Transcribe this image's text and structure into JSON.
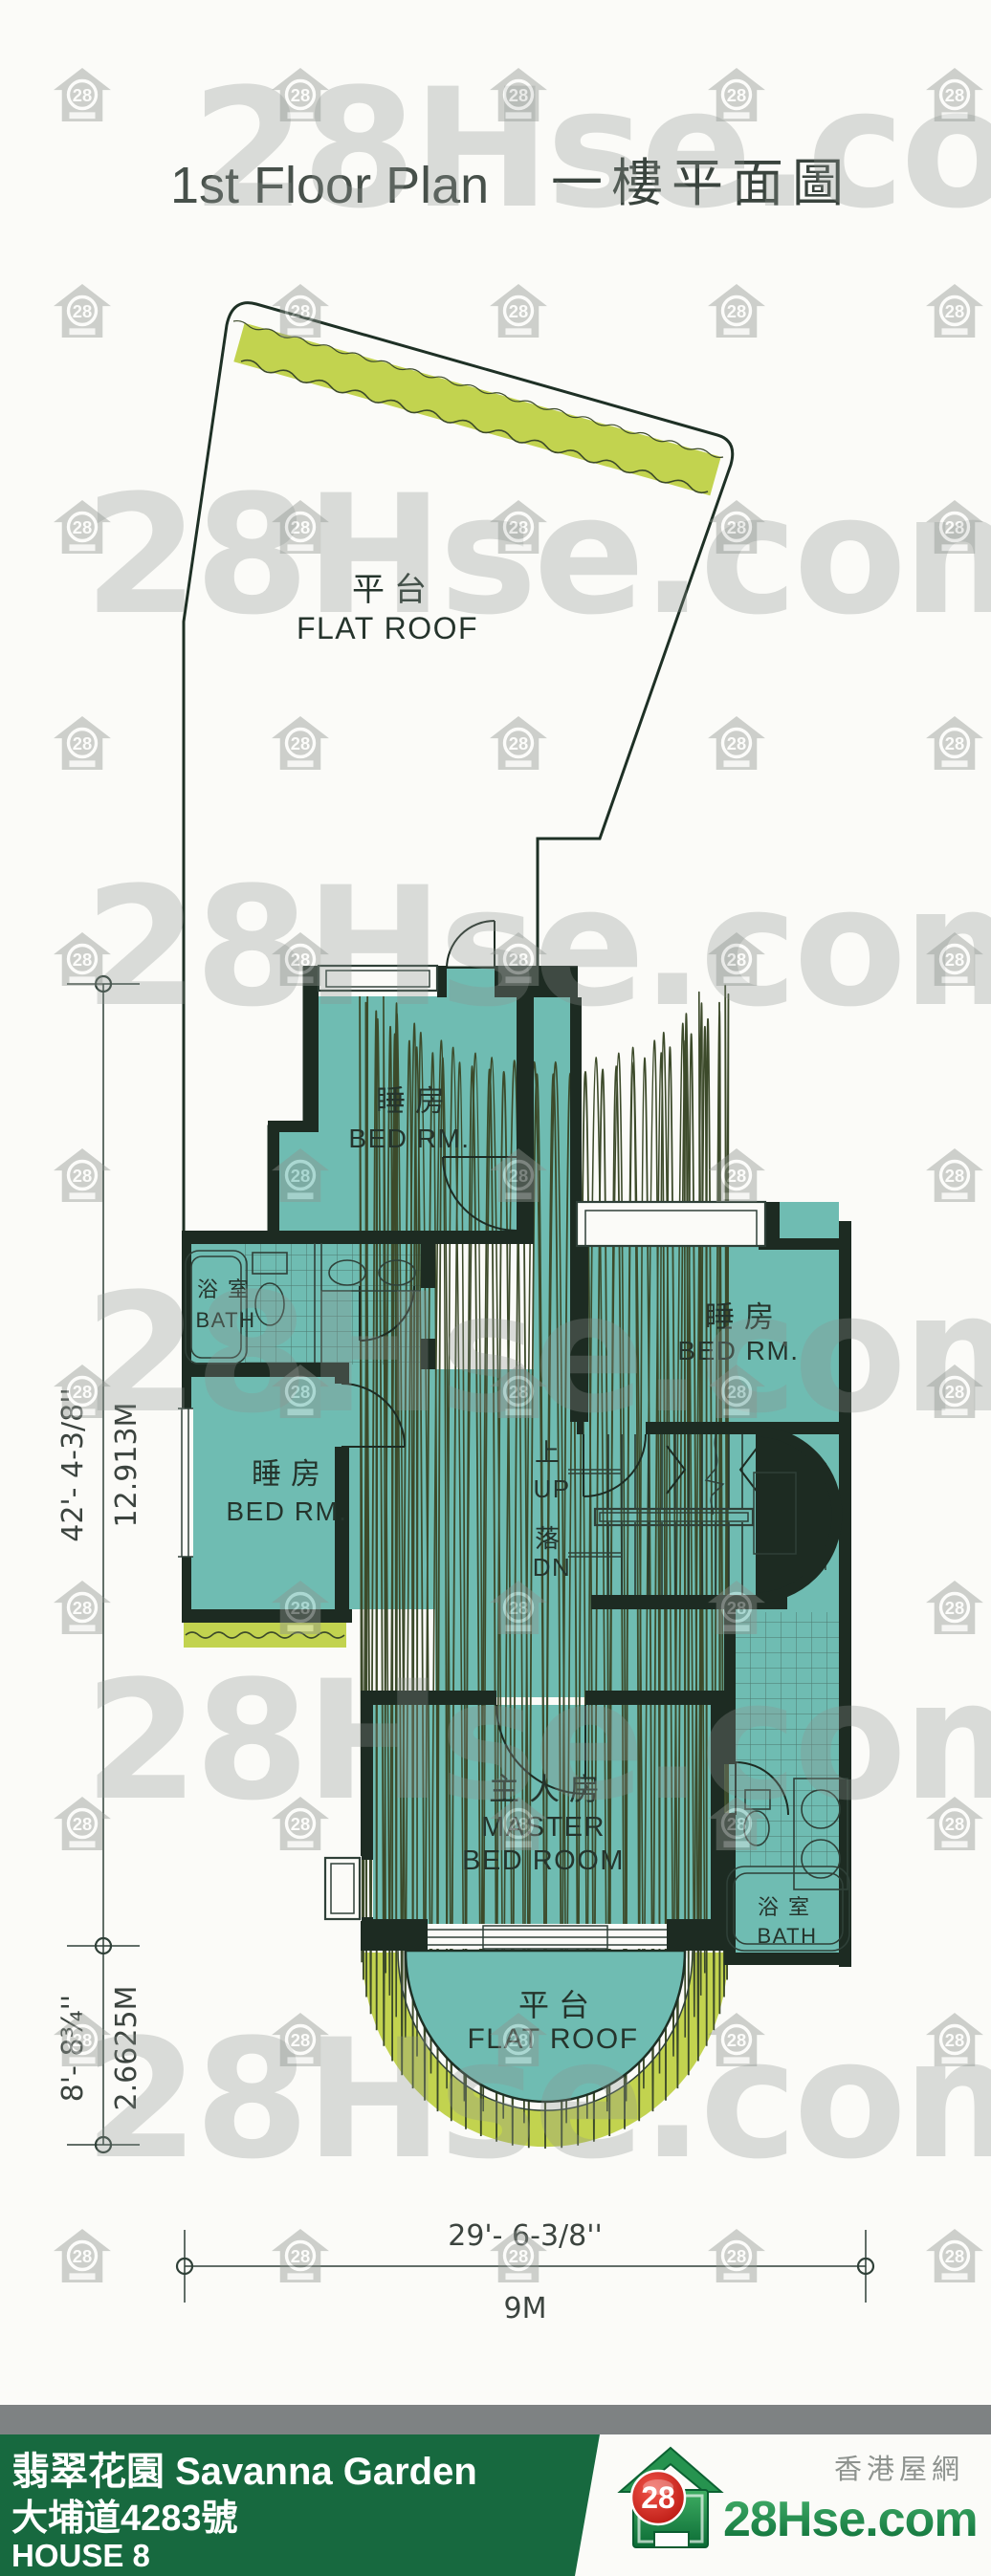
{
  "title": {
    "en": "1st Floor Plan",
    "zh": "一樓平面圖"
  },
  "watermark": {
    "text": "28Hse.com",
    "badge": "28"
  },
  "plan": {
    "flat_roof_top": {
      "zh": "平台",
      "en": "FLAT ROOF"
    },
    "flat_roof_bottom": {
      "zh": "平台",
      "en": "FLAT ROOF"
    },
    "bedroom_top": {
      "zh": "睡房",
      "en": "BED RM."
    },
    "bedroom_right": {
      "zh": "睡房",
      "en": "BED RM."
    },
    "bedroom_left": {
      "zh": "睡房",
      "en": "BED RM."
    },
    "bath_left": {
      "zh": "浴室",
      "en": "BATH"
    },
    "bath_right": {
      "zh": "浴室",
      "en": "BATH"
    },
    "master_bedroom": {
      "zh": "主人房",
      "en_line1": "MASTER",
      "en_line2": "BED ROOM"
    },
    "stairs": {
      "up_zh": "上",
      "up_en": "UP",
      "down_zh": "落",
      "down_en": "DN"
    }
  },
  "dimensions": {
    "left_upper": {
      "imperial": "42'- 4-3/8''",
      "metric": "12.913M"
    },
    "left_lower": {
      "imperial": "8'- 8¾''",
      "metric": "2.6625M"
    },
    "bottom": {
      "imperial": "29'- 6-3/8''",
      "metric": "9M"
    }
  },
  "footer": {
    "estate_name": "翡翠花園 Savanna Garden",
    "address": "大埔道4283號",
    "house": "HOUSE 8",
    "brand": "28Hse.com",
    "brand_badge": "28",
    "tagline": "香港屋網"
  },
  "colors": {
    "flat_roof": "#a6c78a",
    "hedge": "#c2d34f",
    "room": "#6fbcb2",
    "wall": "#1d2b22",
    "footer_green": "#17693f",
    "brand_red": "#d5281f",
    "brand_green": "#0e7c3f",
    "watermark_gray": "#8e948f"
  }
}
